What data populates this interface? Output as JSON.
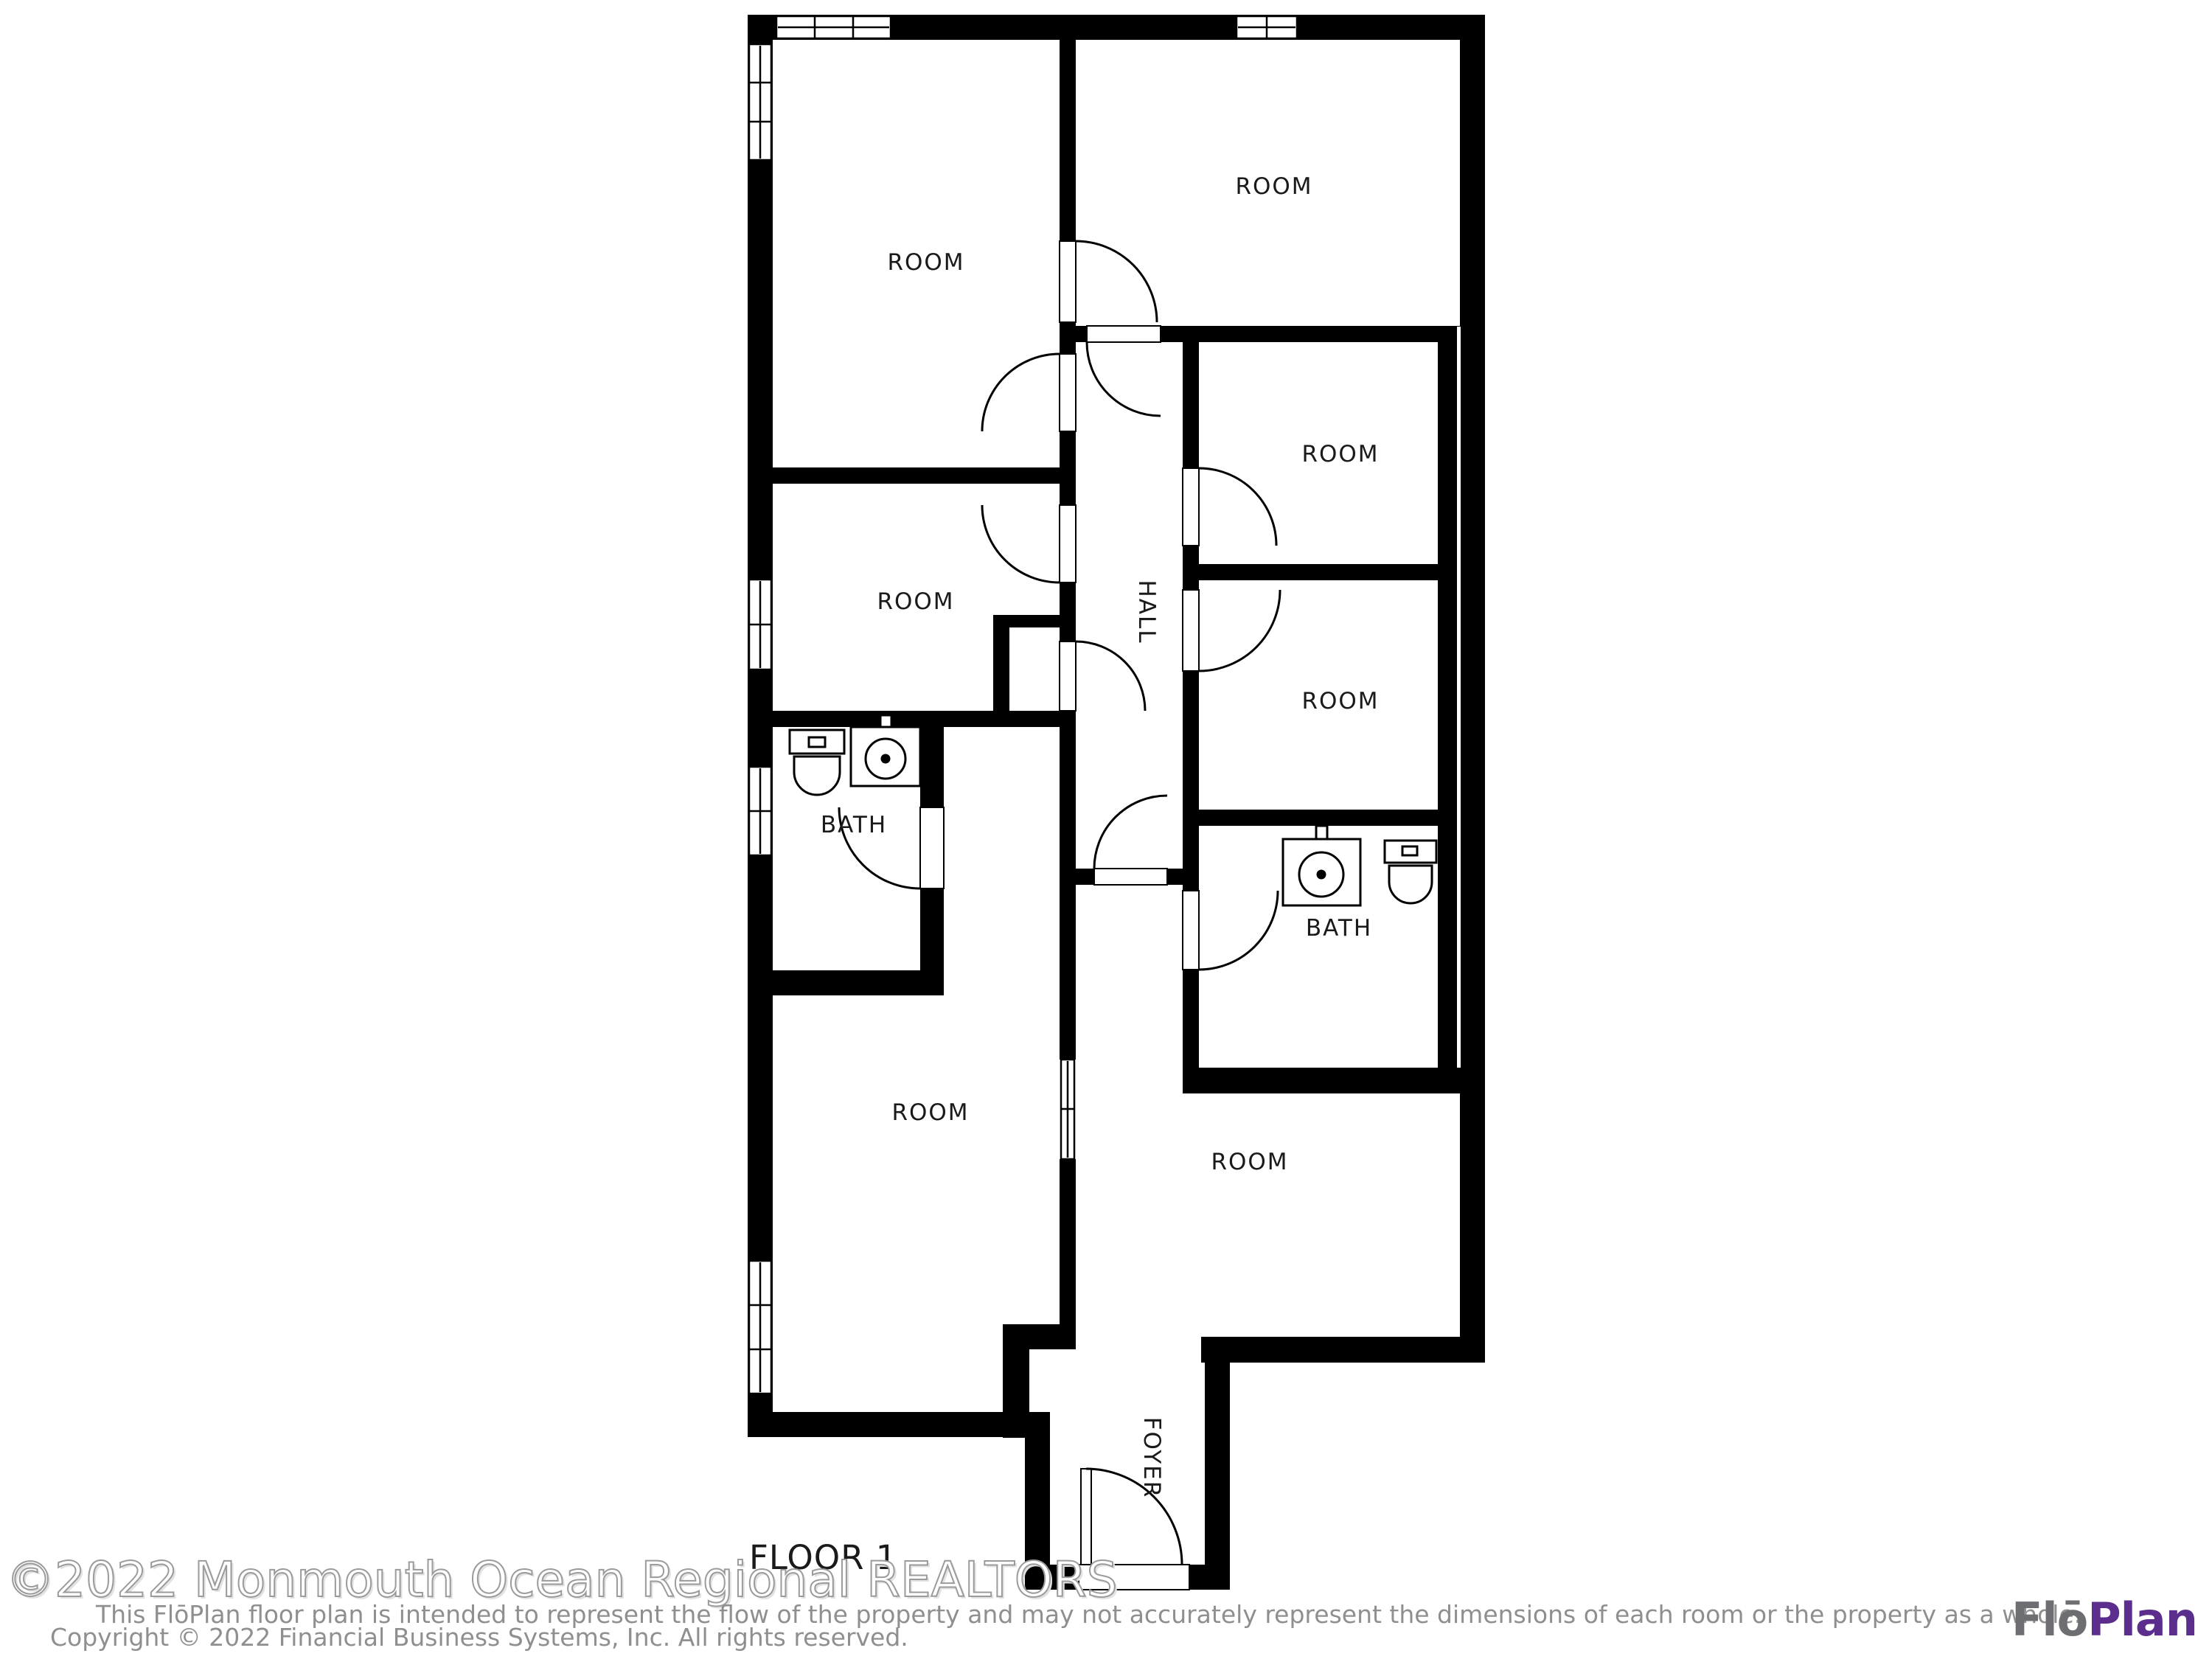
{
  "page": {
    "background": "#ffffff",
    "wall_color": "#000000",
    "label_color": "#1a1a1a"
  },
  "floor_plan": {
    "floor_label": "FLOOR 1",
    "labels": {
      "room_top_left": "ROOM",
      "room_top_right": "ROOM",
      "room_right_upper": "ROOM",
      "room_mid_left": "ROOM",
      "room_right_lower": "ROOM",
      "bath_left": "BATH",
      "bath_right": "BATH",
      "room_bottom_left": "ROOM",
      "room_bottom_right": "ROOM",
      "hall": "HALL",
      "foyer": "FOYER"
    }
  },
  "watermark": {
    "text": "©2022 Monmouth Ocean Regional REALTORS",
    "outline_color": "#9b9b9b"
  },
  "disclaimer": {
    "line1": "This FlōPlan floor plan is intended to represent the flow of the property and may not accurately represent the dimensions of each room or the property as a whole.",
    "line2": "Copyright © 2022 Financial Business Systems, Inc. All rights reserved.",
    "color": "#8f8f8f"
  },
  "logo": {
    "prefix": "Flō",
    "suffix": "Plan",
    "prefix_color": "#6d6e71",
    "suffix_color": "#5b2e8d"
  }
}
